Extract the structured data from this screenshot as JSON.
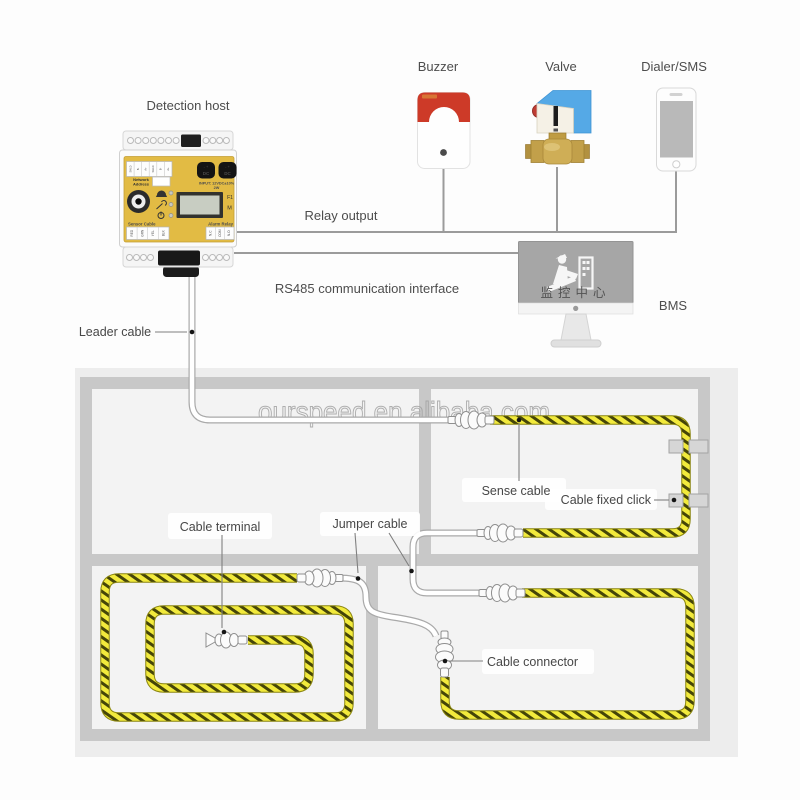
{
  "system": {
    "detection_host": "Detection host",
    "buzzer": "Buzzer",
    "valve": "Valve",
    "dialer_sms": "Dialer/SMS",
    "relay_output": "Relay output",
    "rs485": "RS485 communication interface",
    "bms": "BMS",
    "monitor_screen_text": "监控中心"
  },
  "floorplan": {
    "leader_cable": "Leader cable",
    "sense_cable": "Sense cable",
    "cable_fixed_click": "Cable fixed click",
    "cable_terminal": "Cable terminal",
    "jumper_cable": "Jumper cable",
    "cable_connector": "Cable connector"
  },
  "device_panel": {
    "network_address_line1": "Network",
    "network_address_line2": "Address",
    "dc_label": "DC",
    "polarity": "-  +",
    "input_rating": "INPUT: 12VDC±10%",
    "power_rating": "2W",
    "btn_f1": "F1",
    "btn_m": "M",
    "sensor_cable": "Sensor Cable",
    "alarm_relay": "Alarm Relay",
    "relay_terminals": [
      "N.C",
      "COM",
      "N.O"
    ],
    "sensor_terminals": [
      "RED",
      "GRN",
      "YEL",
      "BLK"
    ],
    "comm_terminals": [
      "SHLD",
      "B-",
      "A+",
      "SHLD",
      "B-",
      "A+"
    ]
  },
  "watermark": "ourspeed.en.alibaba.com",
  "colors": {
    "device_yellow": "#e2bb44",
    "sense_cable_yellow": "#f2ea3c",
    "sense_cable_stripe": "#454508",
    "buzzer_red": "#cd3a28",
    "valve_blue": "#55a9e6",
    "valve_brass": "#cfae56",
    "wall_gray": "#c8c8c8",
    "floor_gray": "#ededed",
    "wire_gray": "#9b9b9b",
    "monitor_screen_gray": "#a6a6a6"
  }
}
